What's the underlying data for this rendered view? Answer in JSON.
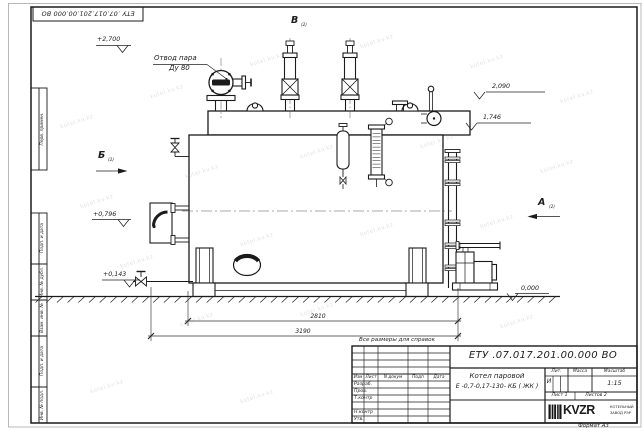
{
  "sheet": {
    "top_stamp": "ЕТУ .07.017.201.00.000  ВО",
    "reference_note": "Все размеры для справок",
    "format_label": "Формат А3",
    "margin_boxes": {
      "perv_primen": "Перв. примен.",
      "podp_i_data_1": "Подп. и дата",
      "inv_no_dubl": "Инв. № дубл.",
      "vzam_inv_no": "Взам. инв. №",
      "podp_i_data_2": "Подп. и дата",
      "inv_no_podl": "Инв. № подл."
    }
  },
  "drawing": {
    "callouts": {
      "steam_outlet_1": "Отвод пара",
      "steam_outlet_2": "Ду 80"
    },
    "views": {
      "a": "А",
      "b": "Б",
      "v": "В",
      "sheet_ref": "(2)"
    },
    "elevations": {
      "top": "+2,700",
      "right_upper": "2,090",
      "right_lower": "1,746",
      "left_upper": "+0,796",
      "left_lower": "+0,143",
      "ground": "0,000"
    },
    "dimensions": {
      "between_supports": "2810",
      "overall": "3190"
    }
  },
  "title_block": {
    "doc_number": "ЕТУ .07.017.201.00.000  ВО",
    "product_name_line1": "Котел паровой",
    "product_name_line2": "Е -0,7-0,17-130- КБ ( ЖК )",
    "columns": {
      "izm": "Изм",
      "list": "Лист",
      "n_dokum": "N докум",
      "podp": "Подп",
      "data": "Дата"
    },
    "rows": {
      "razrab": "Разраб.",
      "prov": "Пров.",
      "t_kontr": "Т.контр",
      "n_kontr": "Н.контр",
      "utv": "Утв."
    },
    "props": {
      "lit_header": "Лит.",
      "massa_header": "Масса",
      "masshtab_header": "Масштаб",
      "lit_value": "И",
      "scale": "1:15",
      "sheet_label": "Лист 1",
      "sheets_label": "Листов 2"
    },
    "logo": {
      "name": "KVZR",
      "line1": "КОТЕЛЬНЫЙ",
      "line2": "ЗАВОД РЭР"
    }
  },
  "watermark": {
    "text": "kotel.kv.kz"
  }
}
